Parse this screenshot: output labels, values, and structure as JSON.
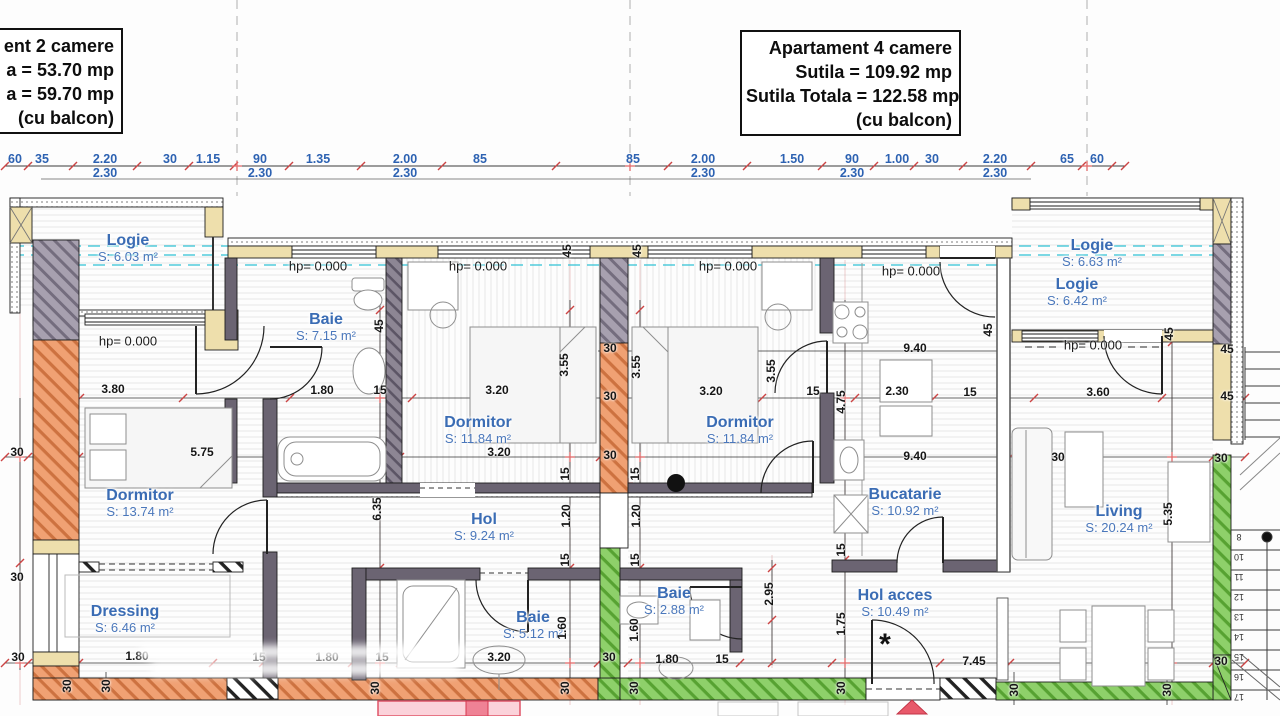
{
  "title_boxes": {
    "left": {
      "lines": [
        "ent 2 camere",
        "a = 53.70 mp",
        "a = 59.70 mp",
        "(cu balcon)"
      ]
    },
    "right": {
      "lines": [
        "Apartament 4 camere",
        "Sutila = 109.92 mp",
        "Sutila Totala = 122.58 mp",
        "(cu balcon)"
      ]
    }
  },
  "colors": {
    "label_blue": "#3a6cb4",
    "dim_blue": "#2d62b2",
    "dim_black": "#161616",
    "wall_orange": "#f0a173",
    "wall_green": "#8ed06a",
    "wall_gray": "#a7a0af",
    "wall_tan": "#eedfac",
    "cyan_line": "#3fc6d8",
    "red_tick": "#cc4444",
    "entrance_red": "#e8596a"
  },
  "rooms": [
    {
      "name": "Logie",
      "area": "S: 6.03 m²",
      "x": 128,
      "y": 248
    },
    {
      "name": "Baie",
      "area": "S: 7.15 m²",
      "x": 326,
      "y": 327
    },
    {
      "name": "Dormitor",
      "area": "S: 11.84 m²",
      "x": 478,
      "y": 430
    },
    {
      "name": "Dormitor",
      "area": "S: 11.84 m²",
      "x": 740,
      "y": 430
    },
    {
      "name": "Dormitor",
      "area": "S: 13.74 m²",
      "x": 140,
      "y": 503
    },
    {
      "name": "Dressing",
      "area": "S: 6.46 m²",
      "x": 125,
      "y": 619
    },
    {
      "name": "Hol",
      "area": "S: 9.24 m²",
      "x": 484,
      "y": 527
    },
    {
      "name": "Baie",
      "area": "S: 5.12 m²",
      "x": 533,
      "y": 625
    },
    {
      "name": "Baie",
      "area": "S: 2.88 m²",
      "x": 674,
      "y": 601
    },
    {
      "name": "Bucatarie",
      "area": "S: 10.92 m²",
      "x": 905,
      "y": 502
    },
    {
      "name": "Hol acces",
      "area": "S: 10.49 m²",
      "x": 895,
      "y": 603
    },
    {
      "name": "Living",
      "area": "S: 20.24 m²",
      "x": 1119,
      "y": 519
    },
    {
      "name": "Logie",
      "area": "S: 6.63 m²",
      "x": 1092,
      "y": 253
    },
    {
      "name": "Logie",
      "area": "S: 6.42 m²",
      "x": 1077,
      "y": 292
    }
  ],
  "hp_labels": [
    {
      "t": "hp= 0.000",
      "x": 128,
      "y": 341
    },
    {
      "t": "hp= 0.000",
      "x": 318,
      "y": 266
    },
    {
      "t": "hp= 0.000",
      "x": 478,
      "y": 266
    },
    {
      "t": "hp= 0.000",
      "x": 728,
      "y": 266
    },
    {
      "t": "hp= 0.000",
      "x": 911,
      "y": 271
    },
    {
      "t": "hp= 0.000",
      "x": 1093,
      "y": 345
    }
  ],
  "dimensions": {
    "top_row1": [
      {
        "t": "60",
        "x": 15
      },
      {
        "t": "35",
        "x": 42
      },
      {
        "t": "2.20",
        "x": 105
      },
      {
        "t": "30",
        "x": 170
      },
      {
        "t": "1.15",
        "x": 208
      },
      {
        "t": "90",
        "x": 260
      },
      {
        "t": "1.35",
        "x": 318
      },
      {
        "t": "2.00",
        "x": 405
      },
      {
        "t": "85",
        "x": 480
      },
      {
        "t": "85",
        "x": 633
      },
      {
        "t": "2.00",
        "x": 703
      },
      {
        "t": "1.50",
        "x": 792
      },
      {
        "t": "90",
        "x": 852
      },
      {
        "t": "1.00",
        "x": 897
      },
      {
        "t": "30",
        "x": 932
      },
      {
        "t": "2.20",
        "x": 995
      },
      {
        "t": "65",
        "x": 1067
      },
      {
        "t": "60",
        "x": 1097
      }
    ],
    "top_row2": [
      {
        "t": "2.30",
        "x": 105
      },
      {
        "t": "2.30",
        "x": 260
      },
      {
        "t": "2.30",
        "x": 405
      },
      {
        "t": "2.30",
        "x": 703
      },
      {
        "t": "2.30",
        "x": 852
      },
      {
        "t": "2.30",
        "x": 995
      }
    ],
    "plan": [
      {
        "t": "3.80",
        "x": 113,
        "y": 389
      },
      {
        "t": "1.80",
        "x": 322,
        "y": 390
      },
      {
        "t": "15",
        "x": 380,
        "y": 390
      },
      {
        "t": "3.20",
        "x": 497,
        "y": 390
      },
      {
        "t": "3.20",
        "x": 711,
        "y": 391
      },
      {
        "t": "15",
        "x": 813,
        "y": 391
      },
      {
        "t": "2.30",
        "x": 897,
        "y": 391
      },
      {
        "t": "15",
        "x": 970,
        "y": 392
      },
      {
        "t": "3.60",
        "x": 1098,
        "y": 392
      },
      {
        "t": "45",
        "x": 1227,
        "y": 396
      },
      {
        "t": "45",
        "x": 379,
        "y": 326,
        "r": 1
      },
      {
        "t": "45",
        "x": 567,
        "y": 251,
        "r": 1
      },
      {
        "t": "45",
        "x": 637,
        "y": 251,
        "r": 1
      },
      {
        "t": "45",
        "x": 988,
        "y": 330,
        "r": 1
      },
      {
        "t": "45",
        "x": 1169,
        "y": 334,
        "r": 1
      },
      {
        "t": "45",
        "x": 1227,
        "y": 349
      },
      {
        "t": "3.55",
        "x": 564,
        "y": 365,
        "r": 1
      },
      {
        "t": "3.55",
        "x": 636,
        "y": 367,
        "r": 1
      },
      {
        "t": "3.55",
        "x": 771,
        "y": 371,
        "r": 1
      },
      {
        "t": "30",
        "x": 610,
        "y": 348
      },
      {
        "t": "9.40",
        "x": 915,
        "y": 348
      },
      {
        "t": "30",
        "x": 17,
        "y": 452
      },
      {
        "t": "5.75",
        "x": 202,
        "y": 452
      },
      {
        "t": "30",
        "x": 610,
        "y": 396
      },
      {
        "t": "3.20",
        "x": 499,
        "y": 452
      },
      {
        "t": "30",
        "x": 610,
        "y": 455
      },
      {
        "t": "9.40",
        "x": 915,
        "y": 456
      },
      {
        "t": "30",
        "x": 1058,
        "y": 457
      },
      {
        "t": "30",
        "x": 1221,
        "y": 458
      },
      {
        "t": "15",
        "x": 565,
        "y": 474,
        "r": 1
      },
      {
        "t": "15",
        "x": 635,
        "y": 474,
        "r": 1
      },
      {
        "t": "4.75",
        "x": 841,
        "y": 402,
        "r": 1
      },
      {
        "t": "6.35",
        "x": 377,
        "y": 509,
        "r": 1
      },
      {
        "t": "1.20",
        "x": 566,
        "y": 516,
        "r": 1
      },
      {
        "t": "1.20",
        "x": 636,
        "y": 516,
        "r": 1
      },
      {
        "t": "5.35",
        "x": 1168,
        "y": 514,
        "r": 1
      },
      {
        "t": "15",
        "x": 565,
        "y": 560,
        "r": 1
      },
      {
        "t": "15",
        "x": 635,
        "y": 560,
        "r": 1
      },
      {
        "t": "15",
        "x": 841,
        "y": 550,
        "r": 1
      },
      {
        "t": "2.95",
        "x": 769,
        "y": 594,
        "r": 1
      },
      {
        "t": "1.75",
        "x": 841,
        "y": 624,
        "r": 1
      },
      {
        "t": "30",
        "x": 17,
        "y": 577
      },
      {
        "t": "1.60",
        "x": 562,
        "y": 628,
        "r": 1
      },
      {
        "t": "1.60",
        "x": 634,
        "y": 630,
        "r": 1
      },
      {
        "t": "30",
        "x": 18,
        "y": 657
      },
      {
        "t": "1.80",
        "x": 137,
        "y": 656
      },
      {
        "t": "15",
        "x": 259,
        "y": 657
      },
      {
        "t": "1.80",
        "x": 327,
        "y": 657
      },
      {
        "t": "15",
        "x": 382,
        "y": 657
      },
      {
        "t": "3.20",
        "x": 499,
        "y": 657
      },
      {
        "t": "30",
        "x": 609,
        "y": 657
      },
      {
        "t": "1.80",
        "x": 667,
        "y": 659
      },
      {
        "t": "15",
        "x": 722,
        "y": 659
      },
      {
        "t": "7.45",
        "x": 974,
        "y": 661
      },
      {
        "t": "30",
        "x": 1221,
        "y": 661
      },
      {
        "t": "30",
        "x": 67,
        "y": 686,
        "r": 1
      },
      {
        "t": "30",
        "x": 106,
        "y": 686,
        "r": 1
      },
      {
        "t": "30",
        "x": 375,
        "y": 688,
        "r": 1
      },
      {
        "t": "30",
        "x": 565,
        "y": 688,
        "r": 1
      },
      {
        "t": "30",
        "x": 634,
        "y": 688,
        "r": 1
      },
      {
        "t": "30",
        "x": 841,
        "y": 688,
        "r": 1
      },
      {
        "t": "30",
        "x": 1014,
        "y": 690,
        "r": 1
      },
      {
        "t": "30",
        "x": 1167,
        "y": 690,
        "r": 1
      }
    ]
  },
  "stairs": {
    "numbers": [
      {
        "t": "8",
        "y": 537
      },
      {
        "t": "10",
        "y": 557
      },
      {
        "t": "11",
        "y": 577
      },
      {
        "t": "12",
        "y": 597
      },
      {
        "t": "13",
        "y": 617
      },
      {
        "t": "14",
        "y": 637
      },
      {
        "t": "15",
        "y": 657
      },
      {
        "t": "16",
        "y": 677
      },
      {
        "t": "17",
        "y": 697
      }
    ],
    "x": 1239
  },
  "markers": {
    "entrance_asterisk": "*"
  }
}
